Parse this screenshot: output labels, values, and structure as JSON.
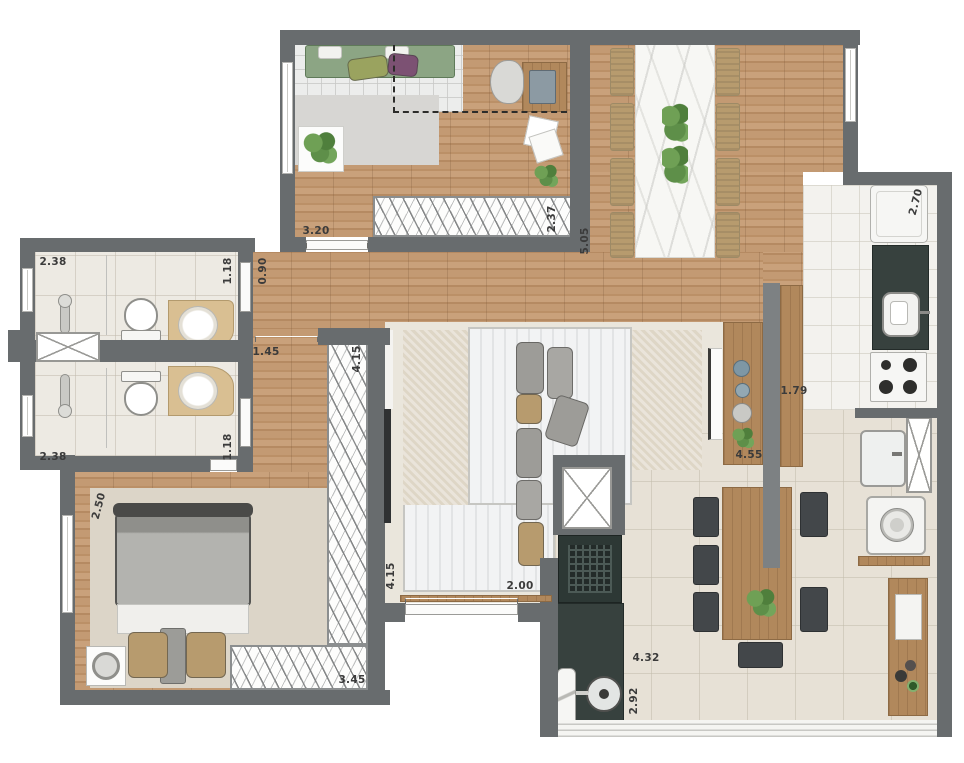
{
  "plan": {
    "title": "apartment-floor-plan",
    "dimensions": [
      {
        "t": "3.20",
        "x": 316,
        "y": 231,
        "r": 0
      },
      {
        "t": "2.37",
        "x": 552,
        "y": 219,
        "r": -90
      },
      {
        "t": "5.05",
        "x": 585,
        "y": 241,
        "r": -90
      },
      {
        "t": "2.70",
        "x": 916,
        "y": 202,
        "r": -75
      },
      {
        "t": "1.18",
        "x": 228,
        "y": 271,
        "r": -90
      },
      {
        "t": "0.90",
        "x": 263,
        "y": 271,
        "r": -90
      },
      {
        "t": "2.38",
        "x": 53,
        "y": 262,
        "r": 0
      },
      {
        "t": "1.45",
        "x": 266,
        "y": 352,
        "r": 0
      },
      {
        "t": "2.38",
        "x": 53,
        "y": 457,
        "r": 0
      },
      {
        "t": "1.18",
        "x": 228,
        "y": 447,
        "r": -90
      },
      {
        "t": "2.50",
        "x": 99,
        "y": 506,
        "r": -75
      },
      {
        "t": "4.15",
        "x": 357,
        "y": 359,
        "r": -90
      },
      {
        "t": "4.15",
        "x": 391,
        "y": 576,
        "r": -90
      },
      {
        "t": "3.45",
        "x": 352,
        "y": 680,
        "r": 0
      },
      {
        "t": "2.00",
        "x": 520,
        "y": 586,
        "r": 0
      },
      {
        "t": "1.79",
        "x": 794,
        "y": 391,
        "r": 0
      },
      {
        "t": "4.55",
        "x": 749,
        "y": 455,
        "r": 0
      },
      {
        "t": "4.32",
        "x": 646,
        "y": 658,
        "r": 0
      },
      {
        "t": "2.92",
        "x": 634,
        "y": 701,
        "r": -90
      }
    ],
    "furniture_icons": [
      "green-sofa-icon",
      "coffee-table-icon",
      "desk-icon",
      "office-chair-icon",
      "laptop-icon",
      "wardrobe-hatch-icon",
      "dining-table-icon",
      "dining-chair-icon",
      "centerpiece-plant-icon",
      "fridge-icon",
      "kitchen-sink-icon",
      "cooktop-icon",
      "pantry-cabinet-icon",
      "media-console-icon",
      "tv-panel-icon",
      "sectional-sofa-icon",
      "toilet-icon",
      "shower-mixer-icon",
      "vanity-sink-icon",
      "service-shaft-icon",
      "double-bed-icon",
      "nightstand-icon",
      "barbecue-grill-icon",
      "round-sink-icon",
      "outdoor-table-icon",
      "outdoor-chair-icon",
      "laundry-tank-icon",
      "washing-machine-icon",
      "buffet-icon",
      "sliding-door-icon",
      "window-icon"
    ],
    "colors": {
      "wall": "#686c6e",
      "wall_light": "#7d8183",
      "wood_floor": "#c39a73",
      "wood_floor_dark": "#b58a62",
      "wood_furniture": "#b1885c",
      "dark_counter": "#37413e",
      "charcoal_chair": "#43474a",
      "bath_floor": "#edeae3",
      "kitchen_floor": "#f3f2ee",
      "terrace_floor": "#e7e1d6",
      "living_floor": "#eae6dc",
      "rug_gray": "#d7d6d3",
      "rug_white": "#f2f3f4",
      "rug_textured": "#ded6c6",
      "bedroom_rug": "#dcd5c8",
      "sofa_green": "#8ca584",
      "cushion_olive": "#9aa35f",
      "cushion_purple": "#7c5173",
      "cushion_tan": "#b79b6e",
      "cushion_gray": "#9d9c98",
      "marble": "#f7f7f4",
      "plant_green": "#5e8f49",
      "label_text": "#3b3b3b"
    }
  }
}
